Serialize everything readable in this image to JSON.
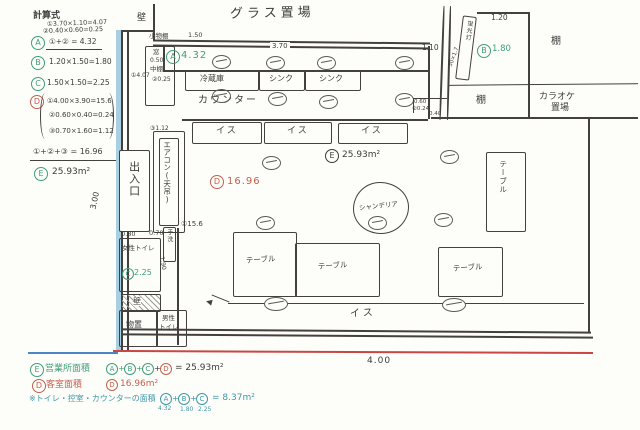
{
  "calc": {
    "title": "計算式",
    "a1": "①3.70×1.10=4.07",
    "a2": "②0.40×0.60=0.25",
    "a_sum": "①+② = 4.32",
    "b_text": "1.20×1.50=1.80",
    "c_text": "1.50×1.50=2.25",
    "d1": "①4.00×3.90=15.6",
    "d2": "②0.60×0.40=0.24",
    "d3": "③0.70×1.60=1.12",
    "d_sum": "①+②+③ = 16.96",
    "e_text": "25.93m²"
  },
  "badges": {
    "a": "A",
    "b": "B",
    "c": "C",
    "d": "D",
    "e": "E"
  },
  "legend": {
    "plus": "+",
    "r1_label": "営業所面積",
    "r1_result": "= 25.93m²",
    "r2_label": "客室面積",
    "r2_value": "16.96m²",
    "r3_label": "※トイレ・控室・カウンターの面積",
    "r3_result": "= 8.37m²",
    "r3_subs": [
      "4.32",
      "1.80",
      "2.25"
    ]
  },
  "plan": {
    "glass_storage": "グラス置場",
    "wall": "壁",
    "small_shelf": "小物棚",
    "window": "窓",
    "mid_shelf": "中棚",
    "counter": "カウンター",
    "fridge": "冷蔵庫",
    "sink": "シンク",
    "chair": "イス",
    "aircon": "エアコン(天吊)",
    "entrance": "出入口",
    "women_toilet": "女性トイレ",
    "men_toilet_1": "男性",
    "men_toilet_2": "トイレ",
    "hand_wash": "手洗",
    "storage_room": "物置",
    "chandelier": "シャンデリア",
    "table": "テーブル",
    "shelf": "棚",
    "karaoke_1": "カラオケ",
    "karaoke_2": "置場",
    "light": "蛍光灯"
  },
  "areas": {
    "a": "4.32",
    "b": "1.80",
    "c": "2.25",
    "d": "16.96",
    "e": "25.93m²",
    "m1": "①4.07",
    "m2": "②0.25",
    "m3": "③1.12",
    "m15": "①15.6",
    "m024": "②0.24"
  },
  "dims": {
    "d370": "3.70",
    "d150": "1.50",
    "d050": "0.50",
    "d120": "1.20",
    "d110": "1.10",
    "d300": "3.00",
    "d400": "4.00",
    "d080": "0.80",
    "d070": "0.70",
    "d190": "1.90",
    "d060": "0.60",
    "d040": "0.40",
    "d50x17": "50×1.7"
  }
}
